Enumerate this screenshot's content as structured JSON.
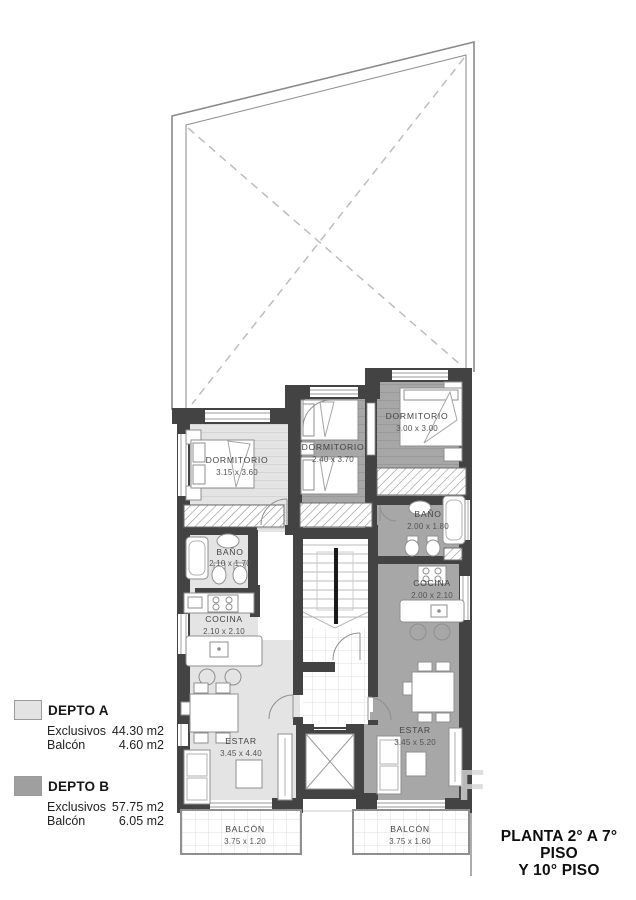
{
  "title": {
    "line1": "PLANTA 2° A 7° PISO",
    "line2": "Y 10° PISO"
  },
  "legend": {
    "depto_a": {
      "name": "DEPTO A",
      "color": "#e3e3e3",
      "exclusivos_label": "Exclusivos",
      "exclusivos_value": "44.30 m2",
      "balcon_label": "Balcón",
      "balcon_value": "4.60 m2"
    },
    "depto_b": {
      "name": "DEPTO B",
      "color": "#9f9f9f",
      "exclusivos_label": "Exclusivos",
      "exclusivos_value": "57.75 m2",
      "balcon_label": "Balcón",
      "balcon_value": "6.05 m2"
    }
  },
  "rooms": {
    "dormitorio_a": {
      "name": "DORMITORIO",
      "dims": "3.15 x 3.60"
    },
    "dormitorio_b1": {
      "name": "DORMITORIO",
      "dims": "2.40 x 3.70"
    },
    "dormitorio_b2": {
      "name": "DORMITORIO",
      "dims": "3.00 x 3.00"
    },
    "bano_a": {
      "name": "BAÑO",
      "dims": "2.10 x 1.70"
    },
    "bano_b": {
      "name": "BAÑO",
      "dims": "2.00 x 1.80"
    },
    "cocina_a": {
      "name": "COCINA",
      "dims": "2.10 x 2.10"
    },
    "cocina_b": {
      "name": "COCINA",
      "dims": "2.00 x 2.10"
    },
    "estar_a": {
      "name": "ESTAR",
      "dims": "3.45 x 4.40"
    },
    "estar_b": {
      "name": "ESTAR",
      "dims": "3.45 x 5.20"
    },
    "balcon_a": {
      "name": "BALCÓN",
      "dims": "3.75 x 1.20"
    },
    "balcon_b": {
      "name": "BALCÓN",
      "dims": "3.75 x 1.60"
    }
  },
  "watermark": "F",
  "colors": {
    "wall": "#434343",
    "depto_a_floor": "#e4e4e4",
    "depto_b_floor": "#a7a7a7",
    "outline": "#8a8a8a"
  }
}
